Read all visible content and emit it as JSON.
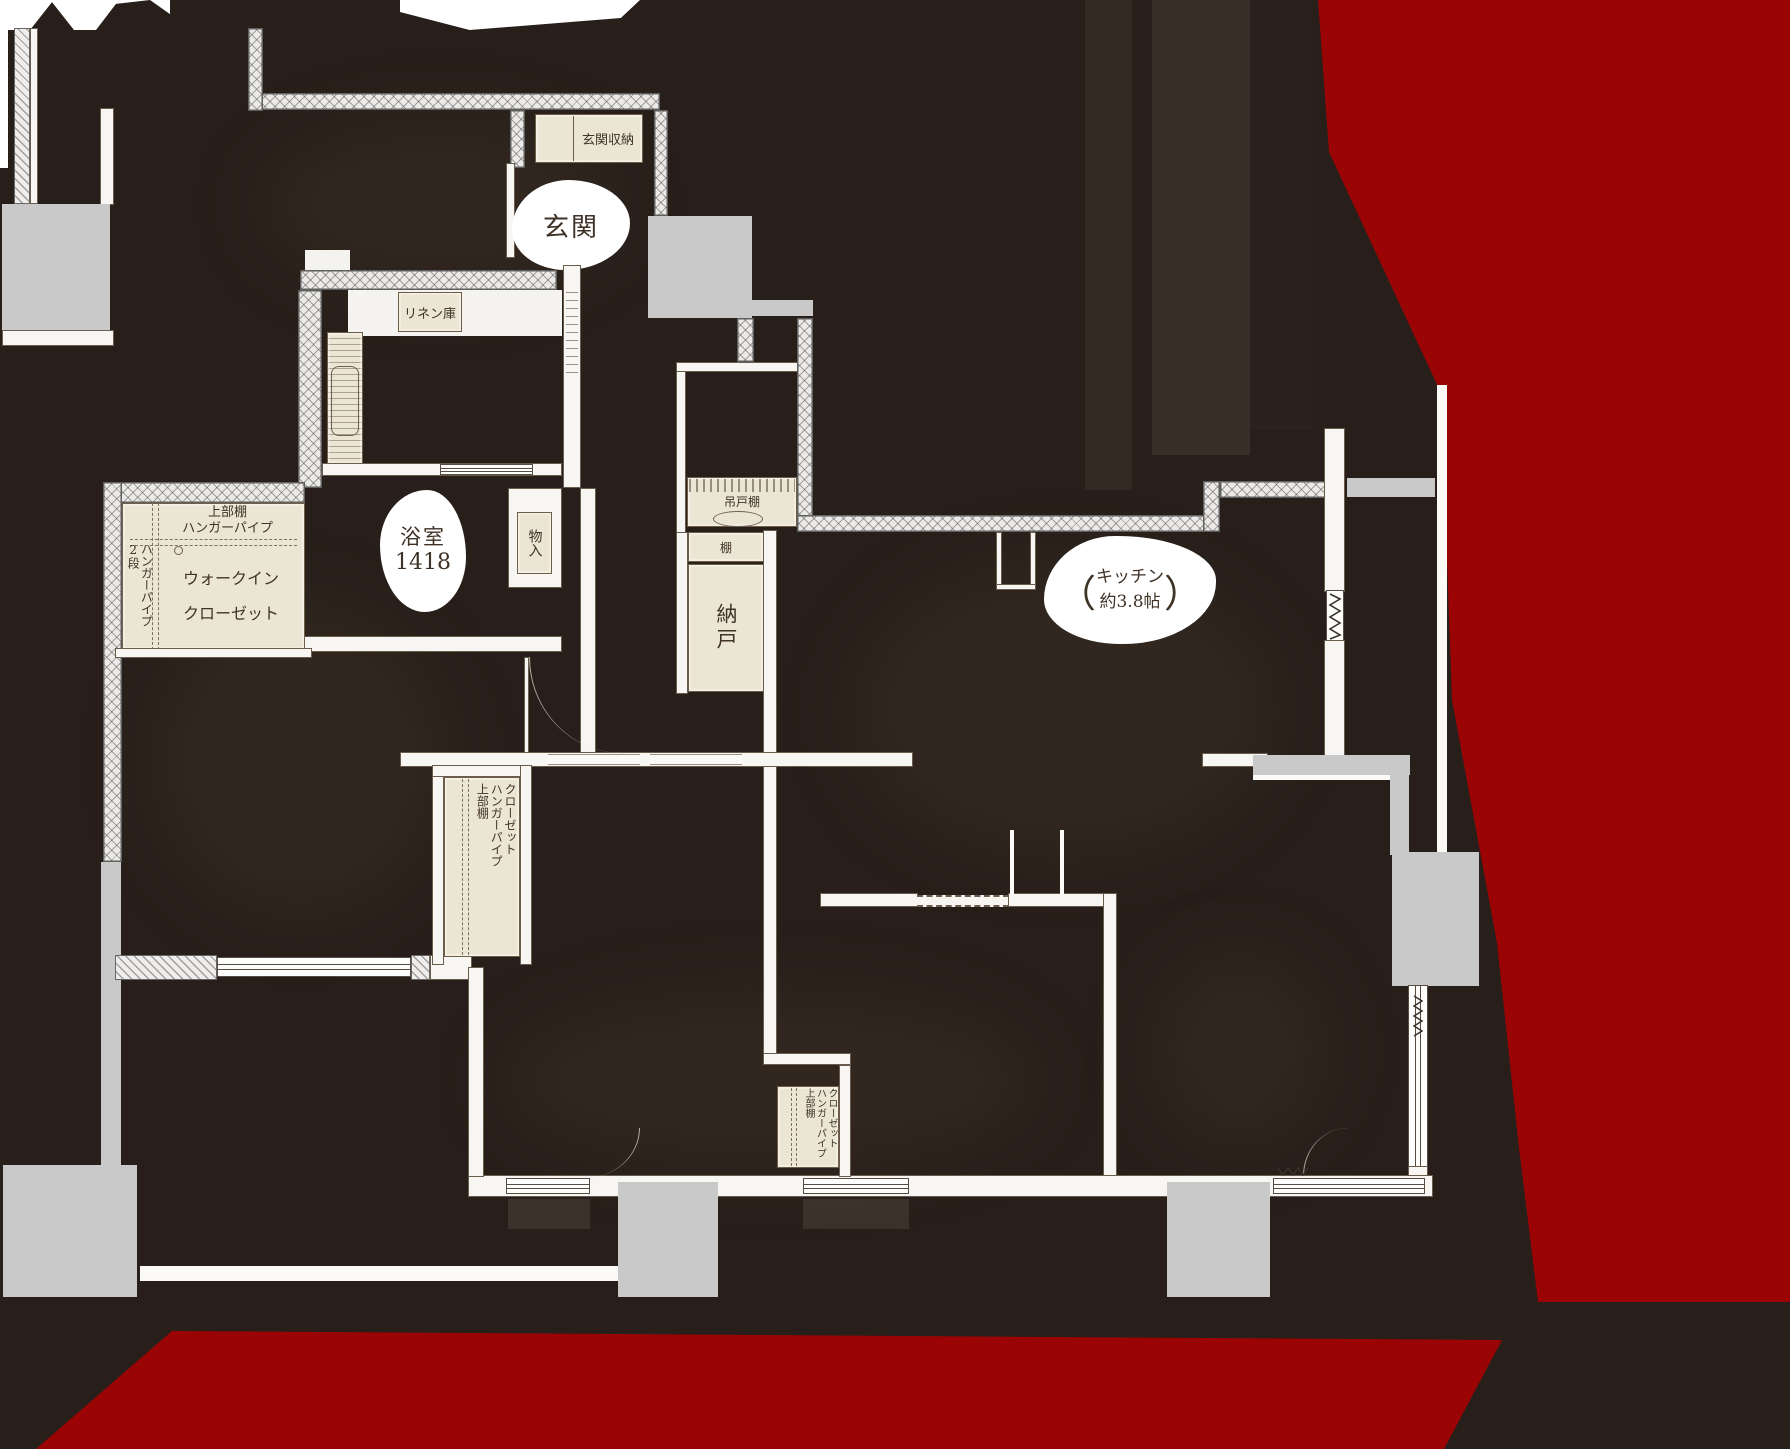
{
  "canvas": {
    "width": 1790,
    "height": 1449
  },
  "colors": {
    "background": "#281f1a",
    "red_overlay": "#9a0404",
    "wall_white": "#f7f6f3",
    "wall_hatch": "#eceae7",
    "room_cream": "#ebe5d3",
    "slab_gray": "#c9c9c9",
    "label_text": "#3f3226"
  },
  "rooms": {
    "entrance": {
      "label": "玄関"
    },
    "entrance_storage": {
      "label": "玄関収納"
    },
    "linen": {
      "label": "リネン庫"
    },
    "bathroom": {
      "label": "浴室",
      "size": "1418"
    },
    "storage_small": {
      "label": "物入"
    },
    "walk_in_closet": {
      "shelf_line1": "上部棚",
      "shelf_line2": "ハンガーパイプ",
      "side_line1": "ハンガーパイプ",
      "side_line2": "2段",
      "name_line1": "ウォークイン",
      "name_line2": "クローゼット"
    },
    "hanging_cupboard": {
      "label": "吊戸棚"
    },
    "shelf": {
      "label": "棚"
    },
    "storeroom": {
      "label": "納戸"
    },
    "kitchen": {
      "paren_open": "（",
      "name": "キッチン",
      "size": "約3.8帖",
      "paren_close": "）"
    },
    "closet_a": {
      "line1": "クローゼット",
      "line2": "ハンガーパイプ",
      "line3": "上部棚"
    },
    "closet_b": {
      "line1": "クローゼット",
      "line2": "ハンガーパイプ",
      "line3": "上部棚"
    }
  }
}
